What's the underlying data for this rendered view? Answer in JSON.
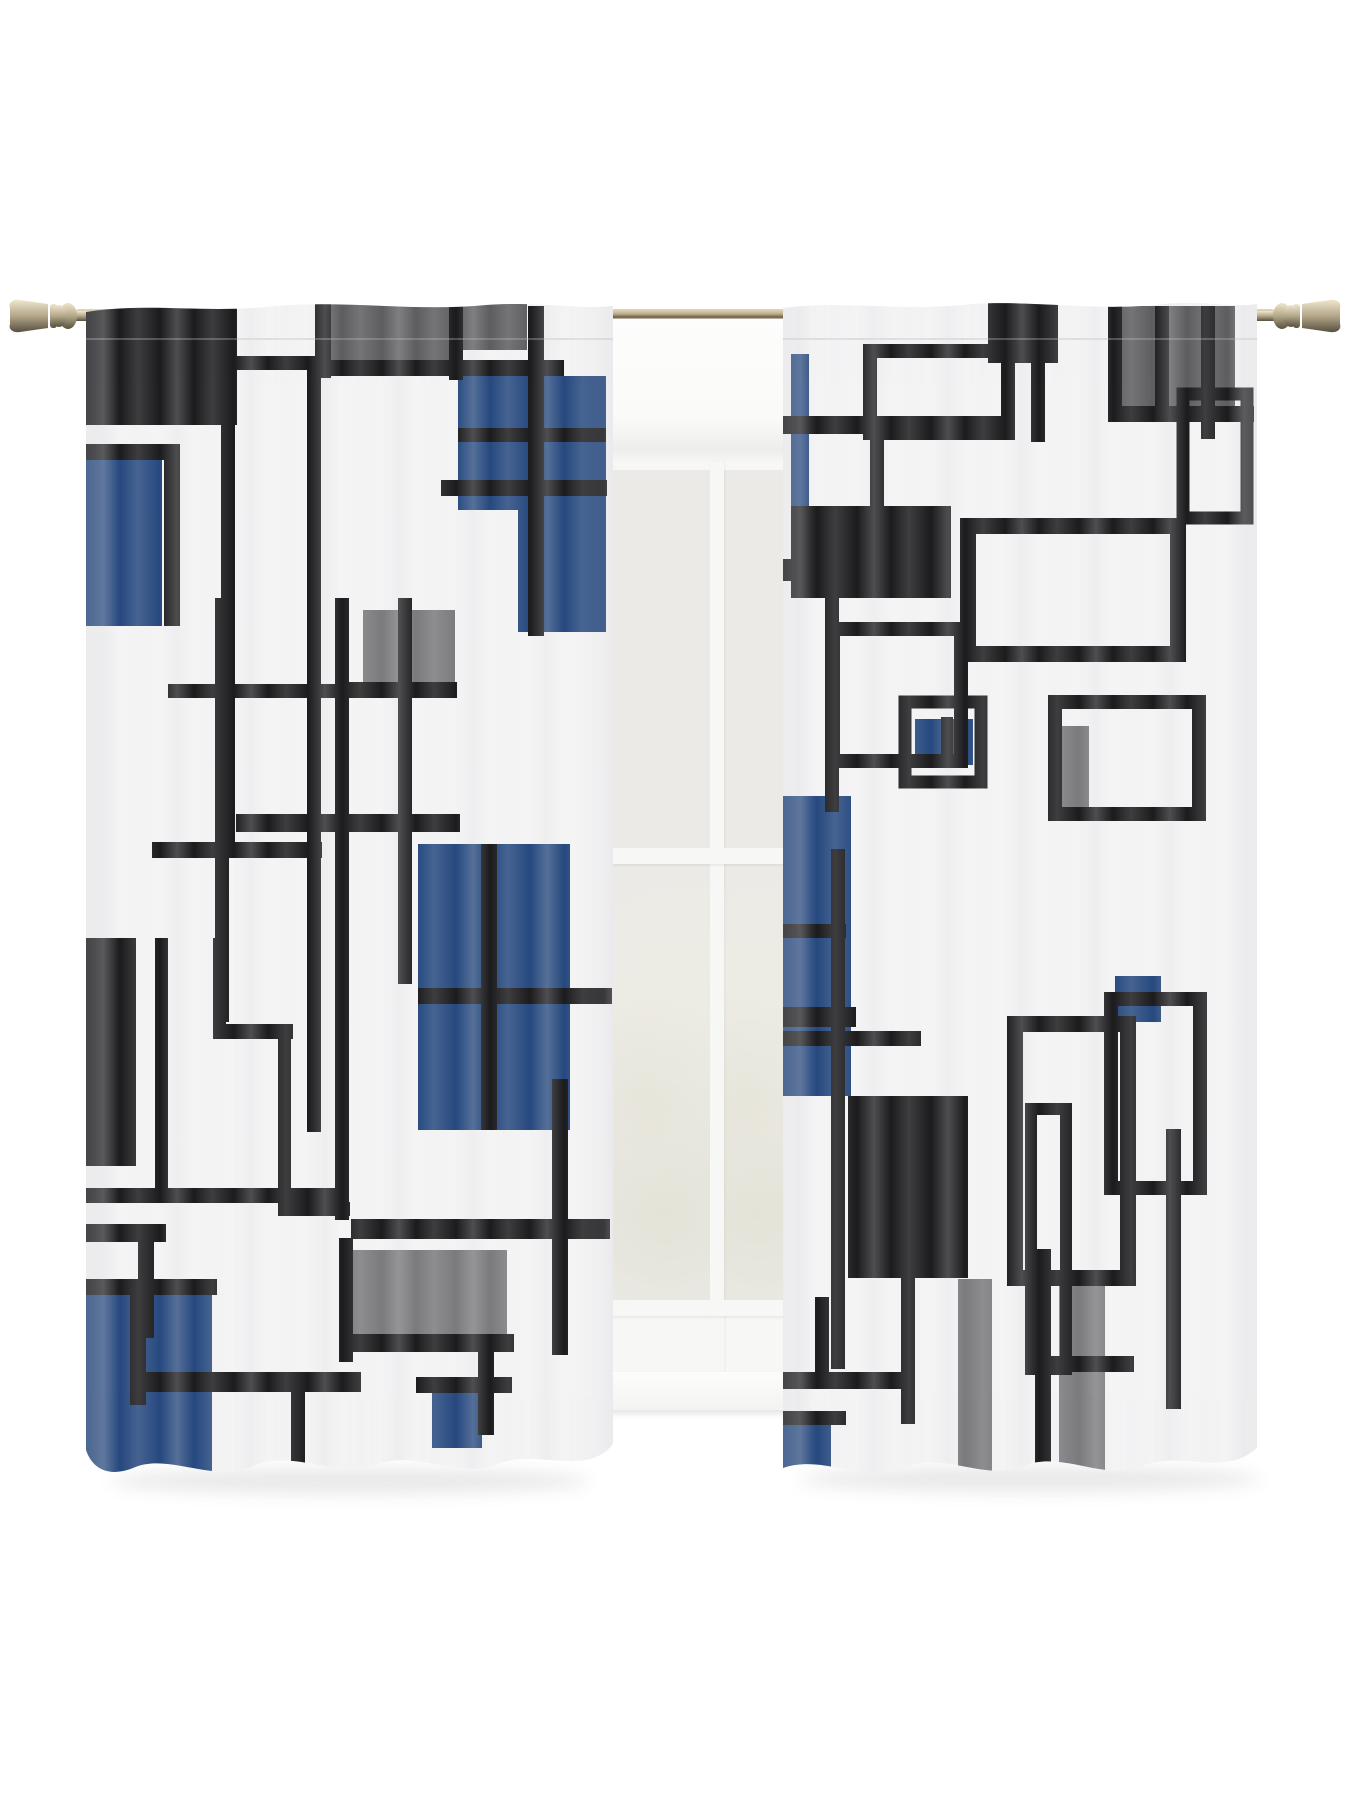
{
  "scene": {
    "subject": "geometric-pattern sheer rod-pocket curtain pair on a brass rod in front of a white window",
    "panel_count": 2,
    "pattern_style": "abstract overlapping squares and rectangle outlines"
  },
  "palette": {
    "black": "#1c1c1e",
    "blue": "#26497f",
    "gray": "#7b7b7e",
    "gray2": "#5e5e61",
    "fabric": "#f4f4f5",
    "wall": "#ffffff",
    "pane": "#ebeae7",
    "frame": "#f7f7f6",
    "rod_light": "#e3d7ba",
    "rod_mid": "#b2a283",
    "rod_dark": "#655a48"
  },
  "panels": {
    "left": {
      "w": 527,
      "h": 1192,
      "shapes": [
        [
          "f",
          "gray2",
          245,
          6,
          118,
          58
        ],
        [
          "f",
          "gray2",
          377,
          6,
          64,
          46
        ],
        [
          "f",
          "gray",
          277,
          312,
          92,
          76
        ],
        [
          "f",
          "gray",
          265,
          952,
          156,
          92
        ],
        [
          "f",
          "blue",
          372,
          78,
          148,
          134
        ],
        [
          "f",
          "blue",
          432,
          120,
          88,
          214
        ],
        [
          "f",
          "blue",
          0,
          160,
          76,
          168
        ],
        [
          "f",
          "blue",
          332,
          546,
          152,
          286
        ],
        [
          "f",
          "blue",
          0,
          984,
          126,
          198
        ],
        [
          "f",
          "blue",
          346,
          1094,
          50,
          56
        ],
        [
          "f",
          "black",
          0,
          0,
          151,
          127
        ],
        [
          "f",
          "black",
          135,
          58,
          14,
          502
        ],
        [
          "f",
          "black",
          135,
          58,
          101,
          14
        ],
        [
          "f",
          "black",
          221,
          58,
          14,
          776
        ],
        [
          "f",
          "black",
          66,
          544,
          170,
          16
        ],
        [
          "f",
          "black",
          229,
          6,
          16,
          74
        ],
        [
          "f",
          "black",
          229,
          62,
          249,
          16
        ],
        [
          "f",
          "black",
          363,
          6,
          14,
          76
        ],
        [
          "f",
          "black",
          442,
          8,
          16,
          330
        ],
        [
          "f",
          "black",
          372,
          130,
          148,
          14
        ],
        [
          "f",
          "black",
          355,
          182,
          166,
          16
        ],
        [
          "f",
          "black",
          0,
          146,
          94,
          16
        ],
        [
          "f",
          "black",
          78,
          146,
          16,
          182
        ],
        [
          "f",
          "black",
          82,
          386,
          168,
          14
        ],
        [
          "f",
          "black",
          129,
          300,
          14,
          424
        ],
        [
          "f",
          "black",
          249,
          300,
          14,
          622
        ],
        [
          "f",
          "black",
          312,
          300,
          14,
          386
        ],
        [
          "f",
          "black",
          249,
          384,
          122,
          16
        ],
        [
          "f",
          "black",
          150,
          516,
          224,
          18
        ],
        [
          "f",
          "black",
          395,
          546,
          16,
          286
        ],
        [
          "f",
          "black",
          332,
          690,
          194,
          16
        ],
        [
          "f",
          "black",
          0,
          640,
          50,
          228
        ],
        [
          "f",
          "black",
          69,
          640,
          13,
          262
        ],
        [
          "f",
          "black",
          127,
          640,
          13,
          100
        ],
        [
          "f",
          "black",
          127,
          726,
          80,
          15
        ],
        [
          "f",
          "black",
          192,
          726,
          13,
          192
        ],
        [
          "f",
          "black",
          192,
          904,
          72,
          14
        ],
        [
          "f",
          "black",
          0,
          890,
          258,
          15
        ],
        [
          "f",
          "black",
          0,
          926,
          80,
          18
        ],
        [
          "f",
          "black",
          52,
          944,
          16,
          96
        ],
        [
          "f",
          "black",
          0,
          981,
          131,
          16
        ],
        [
          "f",
          "black",
          44,
          981,
          16,
          126
        ],
        [
          "f",
          "black",
          44,
          1074,
          231,
          20
        ],
        [
          "f",
          "black",
          205,
          1074,
          14,
          92
        ],
        [
          "f",
          "black",
          253,
          940,
          14,
          124
        ],
        [
          "f",
          "black",
          265,
          921,
          259,
          20
        ],
        [
          "f",
          "black",
          255,
          1036,
          173,
          18
        ],
        [
          "f",
          "black",
          466,
          781,
          16,
          276
        ],
        [
          "f",
          "black",
          392,
          1051,
          16,
          86
        ],
        [
          "f",
          "black",
          330,
          1079,
          96,
          16
        ]
      ]
    },
    "right": {
      "w": 474,
      "h": 1192,
      "shapes": [
        [
          "f",
          "gray2",
          332,
          8,
          120,
          106
        ],
        [
          "f",
          "gray",
          278,
          428,
          28,
          86
        ],
        [
          "f",
          "gray",
          175,
          981,
          34,
          196
        ],
        [
          "f",
          "gray",
          276,
          984,
          46,
          200
        ],
        [
          "f",
          "blue",
          8,
          56,
          18,
          172
        ],
        [
          "f",
          "blue",
          132,
          421,
          58,
          46
        ],
        [
          "f",
          "blue",
          0,
          498,
          68,
          300
        ],
        [
          "f",
          "blue",
          332,
          678,
          46,
          46
        ],
        [
          "f",
          "blue",
          0,
          1125,
          48,
          58
        ],
        [
          "f",
          "black",
          0,
          118,
          225,
          18
        ],
        [
          "s",
          "black",
          87,
          53,
          138,
          82,
          14
        ],
        [
          "f",
          "black",
          205,
          5,
          70,
          60
        ],
        [
          "f",
          "black",
          248,
          64,
          14,
          80
        ],
        [
          "f",
          "black",
          325,
          0,
          14,
          121
        ],
        [
          "f",
          "black",
          325,
          108,
          146,
          16
        ],
        [
          "f",
          "black",
          372,
          8,
          14,
          103
        ],
        [
          "f",
          "black",
          418,
          8,
          14,
          133
        ],
        [
          "s",
          "black",
          400,
          96,
          64,
          124,
          13
        ],
        [
          "f",
          "black",
          8,
          219,
          18,
          14
        ],
        [
          "f",
          "black",
          0,
          261,
          12,
          22
        ],
        [
          "f",
          "black",
          8,
          208,
          160,
          92
        ],
        [
          "f",
          "black",
          87,
          136,
          14,
          74
        ],
        [
          "f",
          "black",
          42,
          298,
          14,
          216
        ],
        [
          "s",
          "black",
          185,
          228,
          210,
          128,
          16
        ],
        [
          "s",
          "black",
          50,
          331,
          128,
          132,
          14
        ],
        [
          "s",
          "black",
          122,
          404,
          76,
          80,
          13
        ],
        [
          "f",
          "black",
          158,
          419,
          12,
          50
        ],
        [
          "s",
          "black",
          272,
          404,
          144,
          112,
          14
        ],
        [
          "f",
          "black",
          0,
          709,
          73,
          20
        ],
        [
          "f",
          "black",
          48,
          551,
          14,
          520
        ],
        [
          "f",
          "black",
          0,
          626,
          63,
          14
        ],
        [
          "f",
          "black",
          65,
          798,
          120,
          182
        ],
        [
          "f",
          "black",
          0,
          733,
          138,
          15
        ],
        [
          "s",
          "black",
          232,
          726,
          113,
          254,
          16
        ],
        [
          "s",
          "black",
          328,
          701,
          89,
          189,
          14
        ],
        [
          "f",
          "black",
          252,
          951,
          16,
          228
        ],
        [
          "f",
          "black",
          252,
          1058,
          99,
          16
        ],
        [
          "f",
          "black",
          383,
          831,
          15,
          280
        ],
        [
          "f",
          "black",
          0,
          1074,
          128,
          17
        ],
        [
          "f",
          "black",
          118,
          978,
          14,
          148
        ],
        [
          "f",
          "black",
          32,
          999,
          14,
          76
        ],
        [
          "f",
          "black",
          0,
          1113,
          63,
          14
        ],
        [
          "s",
          "black",
          248,
          811,
          35,
          260,
          12
        ]
      ]
    }
  }
}
